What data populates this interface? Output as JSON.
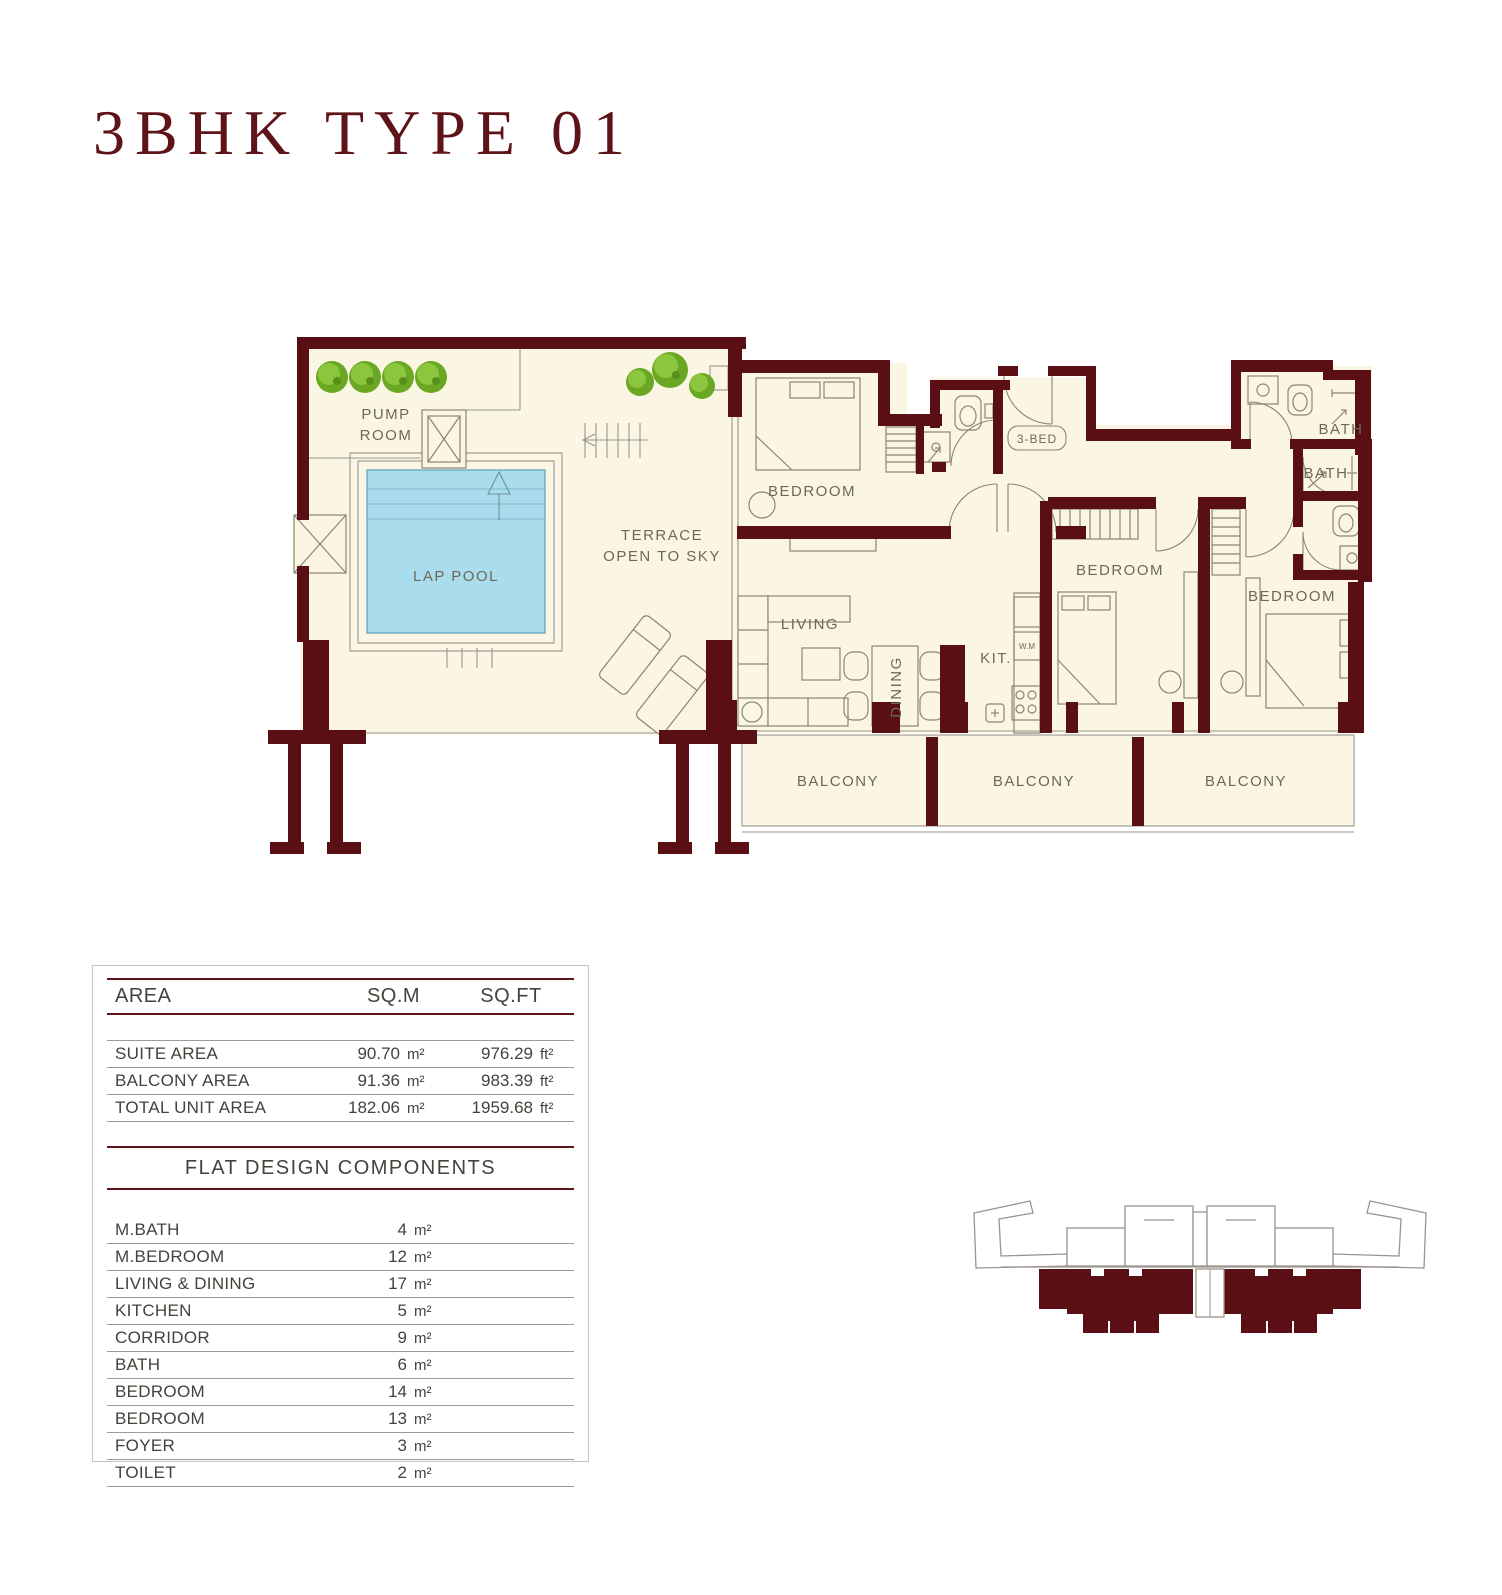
{
  "title": "3BHK TYPE 01",
  "colors": {
    "wall": "#5a0f14",
    "floor": "#fbf6e3",
    "pool": "#a9dcec",
    "tree": "#76b82c",
    "title_text": "#5e1318"
  },
  "plan": {
    "pump_room_line1": "PUMP",
    "pump_room_line2": "ROOM",
    "lap_pool": "LAP POOL",
    "terrace_line1": "TERRACE",
    "terrace_line2": "OPEN TO SKY",
    "bedrooms": [
      "BEDROOM",
      "BEDROOM",
      "BEDROOM"
    ],
    "living": "LIVING",
    "dining": "DINING",
    "kitchen": "KIT.",
    "washing_machine": "W.M",
    "foyer_tag": "3-BED",
    "baths": [
      "BATH",
      "BATH"
    ],
    "balconies": [
      "BALCONY",
      "BALCONY",
      "BALCONY"
    ]
  },
  "area_table": {
    "headers": {
      "area": "AREA",
      "sqm": "SQ.M",
      "sqft": "SQ.FT"
    },
    "rows": [
      {
        "label": "SUITE AREA",
        "sqm": "90.70",
        "sqm_unit": "m²",
        "sqft": "976.29",
        "sqft_unit": "ft²"
      },
      {
        "label": "BALCONY AREA",
        "sqm": "91.36",
        "sqm_unit": "m²",
        "sqft": "983.39",
        "sqft_unit": "ft²"
      },
      {
        "label": "TOTAL UNIT AREA",
        "sqm": "182.06",
        "sqm_unit": "m²",
        "sqft": "1959.68",
        "sqft_unit": "ft²"
      }
    ]
  },
  "components_table": {
    "title": "FLAT DESIGN COMPONENTS",
    "rows": [
      {
        "label": "M.BATH",
        "value": "4",
        "unit": "m²"
      },
      {
        "label": "M.BEDROOM",
        "value": "12",
        "unit": "m²"
      },
      {
        "label": "LIVING & DINING",
        "value": "17",
        "unit": "m²"
      },
      {
        "label": "KITCHEN",
        "value": "5",
        "unit": "m²"
      },
      {
        "label": "CORRIDOR",
        "value": "9",
        "unit": "m²"
      },
      {
        "label": "BATH",
        "value": "6",
        "unit": "m²"
      },
      {
        "label": "BEDROOM",
        "value": "14",
        "unit": "m²"
      },
      {
        "label": "BEDROOM",
        "value": "13",
        "unit": "m²"
      },
      {
        "label": "FOYER",
        "value": "3",
        "unit": "m²"
      },
      {
        "label": "TOILET",
        "value": "2",
        "unit": "m²"
      }
    ]
  }
}
